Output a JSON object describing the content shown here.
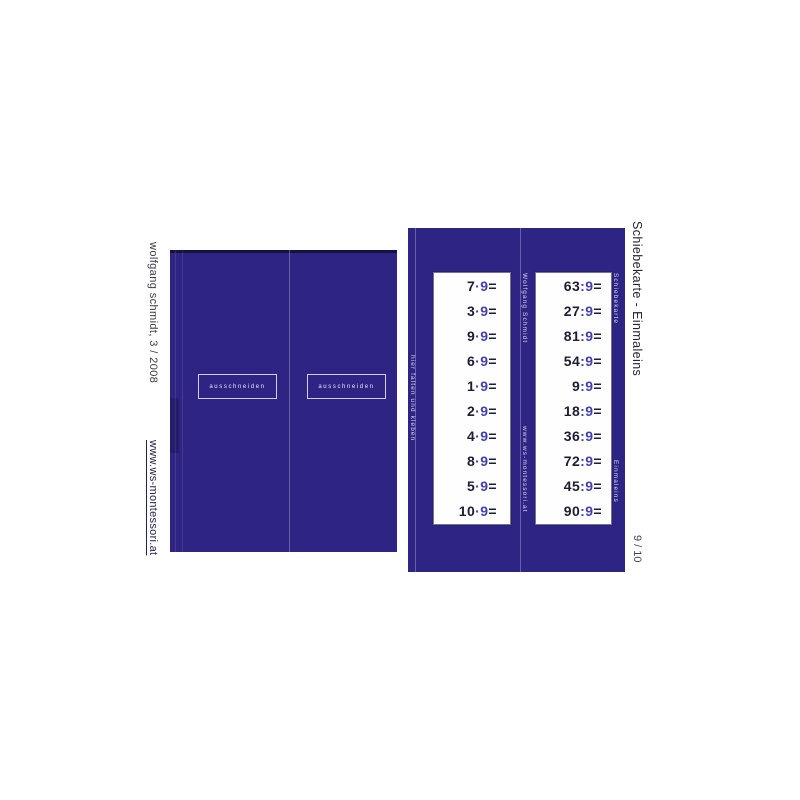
{
  "colors": {
    "panel": "#2e2484",
    "accent": "#4340ae",
    "ink": "#1d1d33"
  },
  "margins": {
    "author": "wolfgang schmidt, 3 / 2008",
    "url": "www.ws-montessori.at",
    "title": "Schiebekarte - Einmaleins",
    "page": "9 / 10"
  },
  "left_card": {
    "cutboxes": [
      {
        "label": "ausschneiden"
      },
      {
        "label": "ausschneiden"
      }
    ]
  },
  "right_card": {
    "fold_hint": "hier falten und kleben",
    "author": "Wolfgang Schmidt",
    "url": "www.ws-montessori.at",
    "label_top": "Schiebekarte",
    "label_bottom": "Einmaleins",
    "equals": "=",
    "multiplication": {
      "operator": "·",
      "operand": "9",
      "rows": [
        "7",
        "3",
        "9",
        "6",
        "1",
        "2",
        "4",
        "8",
        "5",
        "10"
      ]
    },
    "division": {
      "operator": ":",
      "operand": "9",
      "rows": [
        "63",
        "27",
        "81",
        "54",
        "9",
        "18",
        "36",
        "72",
        "45",
        "90"
      ]
    }
  }
}
